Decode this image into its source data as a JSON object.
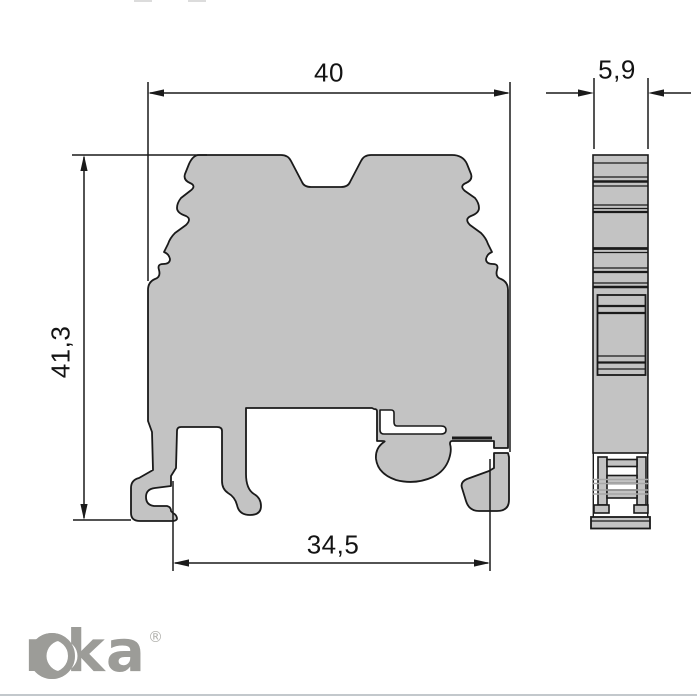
{
  "drawing": {
    "dimensions": {
      "top_width": "40",
      "side_thickness": "5,9",
      "height": "41,3",
      "bottom_width": "34,5"
    },
    "colors": {
      "part_fill": "#c3c3c3",
      "outline": "#1a1a1a",
      "hidden_line": "#a8a8a8"
    }
  },
  "branding": {
    "logo_text": "Onka",
    "logo_rest": "nka",
    "registered_mark": "®",
    "logo_color": "#9c9c98"
  }
}
